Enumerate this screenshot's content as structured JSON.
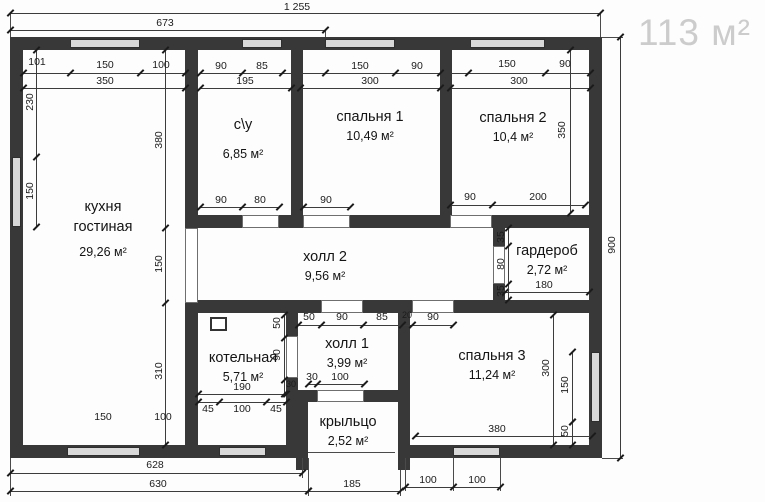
{
  "badge": {
    "total_area": "113 м²"
  },
  "colors": {
    "wall": "#383838",
    "window_fill": "#d8d8d8",
    "dim_line": "#3c3c3c",
    "badge_text": "#cccccc"
  },
  "rooms": [
    {
      "name_lines": [
        "кухня",
        "гостиная"
      ],
      "area": "29,26 м²",
      "x": 103,
      "y": 197,
      "gap": 6
    },
    {
      "name_lines": [
        "с\\у"
      ],
      "area": "6,85 м²",
      "x": 243,
      "y": 115,
      "gap": 10
    },
    {
      "name_lines": [
        "спальня 1"
      ],
      "area": "10,49 м²",
      "x": 370,
      "y": 107,
      "gap": 0
    },
    {
      "name_lines": [
        "спальня 2"
      ],
      "area": "10,4 м²",
      "x": 513,
      "y": 108,
      "gap": 0
    },
    {
      "name_lines": [
        "холл 2"
      ],
      "area": "9,56 м²",
      "x": 325,
      "y": 247,
      "gap": 0
    },
    {
      "name_lines": [
        "гардероб"
      ],
      "area": "2,72 м²",
      "x": 547,
      "y": 241,
      "gap": 0
    },
    {
      "name_lines": [
        "котельная"
      ],
      "area": "5,71 м²",
      "x": 243,
      "y": 348,
      "gap": 0
    },
    {
      "name_lines": [
        "холл 1"
      ],
      "area": "3,99 м²",
      "x": 347,
      "y": 334,
      "gap": 0
    },
    {
      "name_lines": [
        "спальня 3"
      ],
      "area": "11,24 м²",
      "x": 492,
      "y": 346,
      "gap": 0
    },
    {
      "name_lines": [
        "крыльцо"
      ],
      "area": "2,52 м²",
      "x": 348,
      "y": 412,
      "gap": 0
    }
  ],
  "dim_labels": [
    [
      "1 255",
      297,
      7,
      0
    ],
    [
      "673",
      165,
      23,
      0
    ],
    [
      "101",
      37,
      62,
      0
    ],
    [
      "150",
      105,
      65,
      0
    ],
    [
      "100",
      161,
      65,
      0
    ],
    [
      "350",
      105,
      81,
      0
    ],
    [
      "90",
      221,
      66,
      0
    ],
    [
      "85",
      262,
      66,
      0
    ],
    [
      "195",
      245,
      81,
      0
    ],
    [
      "150",
      360,
      66,
      0
    ],
    [
      "90",
      417,
      66,
      0
    ],
    [
      "300",
      370,
      81,
      0
    ],
    [
      "150",
      507,
      64,
      0
    ],
    [
      "90",
      565,
      64,
      0
    ],
    [
      "300",
      519,
      81,
      0
    ],
    [
      "230",
      30,
      102,
      1
    ],
    [
      "150",
      30,
      191,
      1
    ],
    [
      "380",
      159,
      140,
      1
    ],
    [
      "150",
      159,
      264,
      1
    ],
    [
      "310",
      159,
      371,
      1
    ],
    [
      "350",
      562,
      130,
      1
    ],
    [
      "900",
      612,
      245,
      1
    ],
    [
      "90",
      221,
      200,
      0
    ],
    [
      "80",
      260,
      200,
      0
    ],
    [
      "90",
      326,
      200,
      0
    ],
    [
      "90",
      470,
      197,
      0
    ],
    [
      "200",
      538,
      197,
      0
    ],
    [
      "35",
      501,
      237,
      1
    ],
    [
      "80",
      501,
      264,
      1
    ],
    [
      "35",
      501,
      291,
      1
    ],
    [
      "180",
      544,
      285,
      0
    ],
    [
      "50",
      309,
      317,
      0
    ],
    [
      "90",
      342,
      317,
      0
    ],
    [
      "85",
      382,
      317,
      0
    ],
    [
      "20",
      407,
      315,
      2
    ],
    [
      "90",
      433,
      317,
      0
    ],
    [
      "50",
      277,
      323,
      1
    ],
    [
      "90",
      277,
      355,
      1
    ],
    [
      "30",
      291,
      384,
      2
    ],
    [
      "190",
      242,
      387,
      0
    ],
    [
      "45",
      208,
      409,
      0
    ],
    [
      "100",
      242,
      409,
      0
    ],
    [
      "45",
      276,
      409,
      0
    ],
    [
      "30",
      312,
      377,
      0
    ],
    [
      "100",
      340,
      377,
      0
    ],
    [
      "380",
      497,
      429,
      0
    ],
    [
      "300",
      546,
      368,
      1
    ],
    [
      "150",
      565,
      385,
      1
    ],
    [
      "50",
      565,
      431,
      1
    ],
    [
      "150",
      103,
      417,
      0
    ],
    [
      "100",
      163,
      417,
      0
    ],
    [
      "628",
      155,
      465,
      0
    ],
    [
      "630",
      158,
      484,
      0
    ],
    [
      "185",
      352,
      484,
      0
    ],
    [
      "100",
      428,
      480,
      0
    ],
    [
      "100",
      477,
      480,
      0
    ]
  ],
  "plan": {
    "walls": [
      [
        10,
        37,
        592,
        13
      ],
      [
        10,
        37,
        13,
        421
      ],
      [
        589,
        37,
        13,
        421
      ],
      [
        10,
        445,
        288,
        13
      ],
      [
        398,
        445,
        204,
        13
      ],
      [
        185,
        50,
        13,
        395
      ],
      [
        291,
        50,
        12,
        178
      ],
      [
        440,
        50,
        12,
        178
      ],
      [
        185,
        215,
        417,
        13
      ],
      [
        185,
        300,
        417,
        13
      ],
      [
        493,
        228,
        12,
        72
      ],
      [
        286,
        313,
        12,
        132
      ],
      [
        296,
        390,
        12,
        80
      ],
      [
        286,
        390,
        124,
        12
      ],
      [
        398,
        313,
        12,
        157
      ]
    ],
    "windows": [
      [
        70,
        39,
        70,
        9
      ],
      [
        242,
        39,
        40,
        9
      ],
      [
        325,
        39,
        70,
        9
      ],
      [
        470,
        39,
        75,
        9
      ],
      [
        12,
        157,
        9,
        70
      ],
      [
        591,
        352,
        9,
        70
      ],
      [
        67,
        447,
        73,
        9
      ],
      [
        219,
        447,
        47,
        9
      ],
      [
        453,
        447,
        47,
        9
      ]
    ],
    "openings": [
      [
        185,
        228,
        13,
        75
      ],
      [
        242,
        215,
        37,
        13
      ],
      [
        303,
        215,
        47,
        13
      ],
      [
        450,
        215,
        42,
        13
      ],
      [
        493,
        246,
        12,
        38
      ],
      [
        321,
        300,
        42,
        13
      ],
      [
        412,
        300,
        42,
        13
      ],
      [
        286,
        336,
        12,
        42
      ],
      [
        317,
        390,
        47,
        12
      ]
    ],
    "dim_lines": [
      [
        10,
        13,
        600,
        13,
        [
          10,
          600
        ]
      ],
      [
        10,
        30,
        325,
        30,
        [
          10,
          325
        ]
      ],
      [
        23,
        73,
        185,
        73,
        [
          23,
          70,
          140,
          185
        ]
      ],
      [
        23,
        88,
        185,
        88,
        [
          23,
          185
        ]
      ],
      [
        200,
        73,
        291,
        73,
        [
          200,
          242,
          282
        ]
      ],
      [
        200,
        88,
        291,
        88,
        [
          200,
          291
        ]
      ],
      [
        300,
        73,
        440,
        73,
        [
          325,
          395,
          440
        ]
      ],
      [
        300,
        88,
        440,
        88,
        [
          300,
          440
        ]
      ],
      [
        450,
        73,
        590,
        73,
        [
          468,
          545,
          590
        ]
      ],
      [
        450,
        88,
        590,
        88,
        [
          450,
          590
        ]
      ],
      [
        200,
        207,
        279,
        207,
        [
          200,
          242,
          279
        ]
      ],
      [
        303,
        207,
        350,
        207,
        [
          303,
          350
        ]
      ],
      [
        450,
        205,
        585,
        205,
        [
          450,
          492,
          585
        ]
      ],
      [
        298,
        325,
        453,
        325,
        [
          298,
          321,
          363,
          402,
          412,
          453
        ]
      ],
      [
        198,
        394,
        286,
        394,
        [
          198,
          286
        ]
      ],
      [
        198,
        402,
        286,
        402,
        [
          198,
          219,
          266,
          286
        ]
      ],
      [
        308,
        384,
        364,
        384,
        [
          308,
          317,
          364
        ]
      ],
      [
        415,
        436,
        592,
        436,
        [
          415,
          592
        ]
      ],
      [
        10,
        473,
        302,
        473,
        [
          10,
          302
        ]
      ],
      [
        10,
        491,
        308,
        491,
        [
          10,
          308
        ]
      ],
      [
        308,
        491,
        400,
        491,
        [
          308,
          400
        ]
      ],
      [
        405,
        487,
        500,
        487,
        [
          405,
          453,
          500
        ]
      ],
      [
        505,
        292,
        589,
        292,
        [
          505,
          589
        ]
      ],
      [
        36,
        50,
        36,
        227,
        [
          50,
          157,
          227
        ]
      ],
      [
        165,
        50,
        165,
        445,
        [
          50,
          228,
          303,
          445
        ]
      ],
      [
        620,
        37,
        620,
        458,
        [
          37,
          458
        ]
      ],
      [
        570,
        50,
        570,
        213,
        [
          50,
          213
        ]
      ],
      [
        508,
        228,
        508,
        300,
        [
          228,
          246,
          284,
          300
        ]
      ],
      [
        284,
        315,
        284,
        394,
        [
          315,
          338,
          380,
          394
        ]
      ],
      [
        553,
        315,
        553,
        445,
        [
          315,
          445
        ]
      ],
      [
        572,
        352,
        572,
        422,
        [
          352,
          422
        ]
      ],
      [
        572,
        422,
        572,
        445,
        [
          422,
          445
        ]
      ]
    ],
    "thin_lines": [
      [
        10,
        13,
        10,
        37
      ],
      [
        600,
        13,
        600,
        37
      ],
      [
        325,
        30,
        325,
        37
      ],
      [
        308,
        452,
        395,
        452
      ],
      [
        302,
        458,
        302,
        478
      ],
      [
        10,
        458,
        10,
        496
      ],
      [
        308,
        458,
        308,
        496
      ],
      [
        400,
        470,
        400,
        496
      ],
      [
        405,
        458,
        405,
        491
      ],
      [
        453,
        458,
        453,
        491
      ],
      [
        500,
        458,
        500,
        491
      ],
      [
        602,
        37,
        623,
        37
      ],
      [
        602,
        458,
        623,
        458
      ]
    ],
    "boiler_symbol": {
      "x": 210,
      "y": 317,
      "w": 17,
      "h": 14
    }
  }
}
